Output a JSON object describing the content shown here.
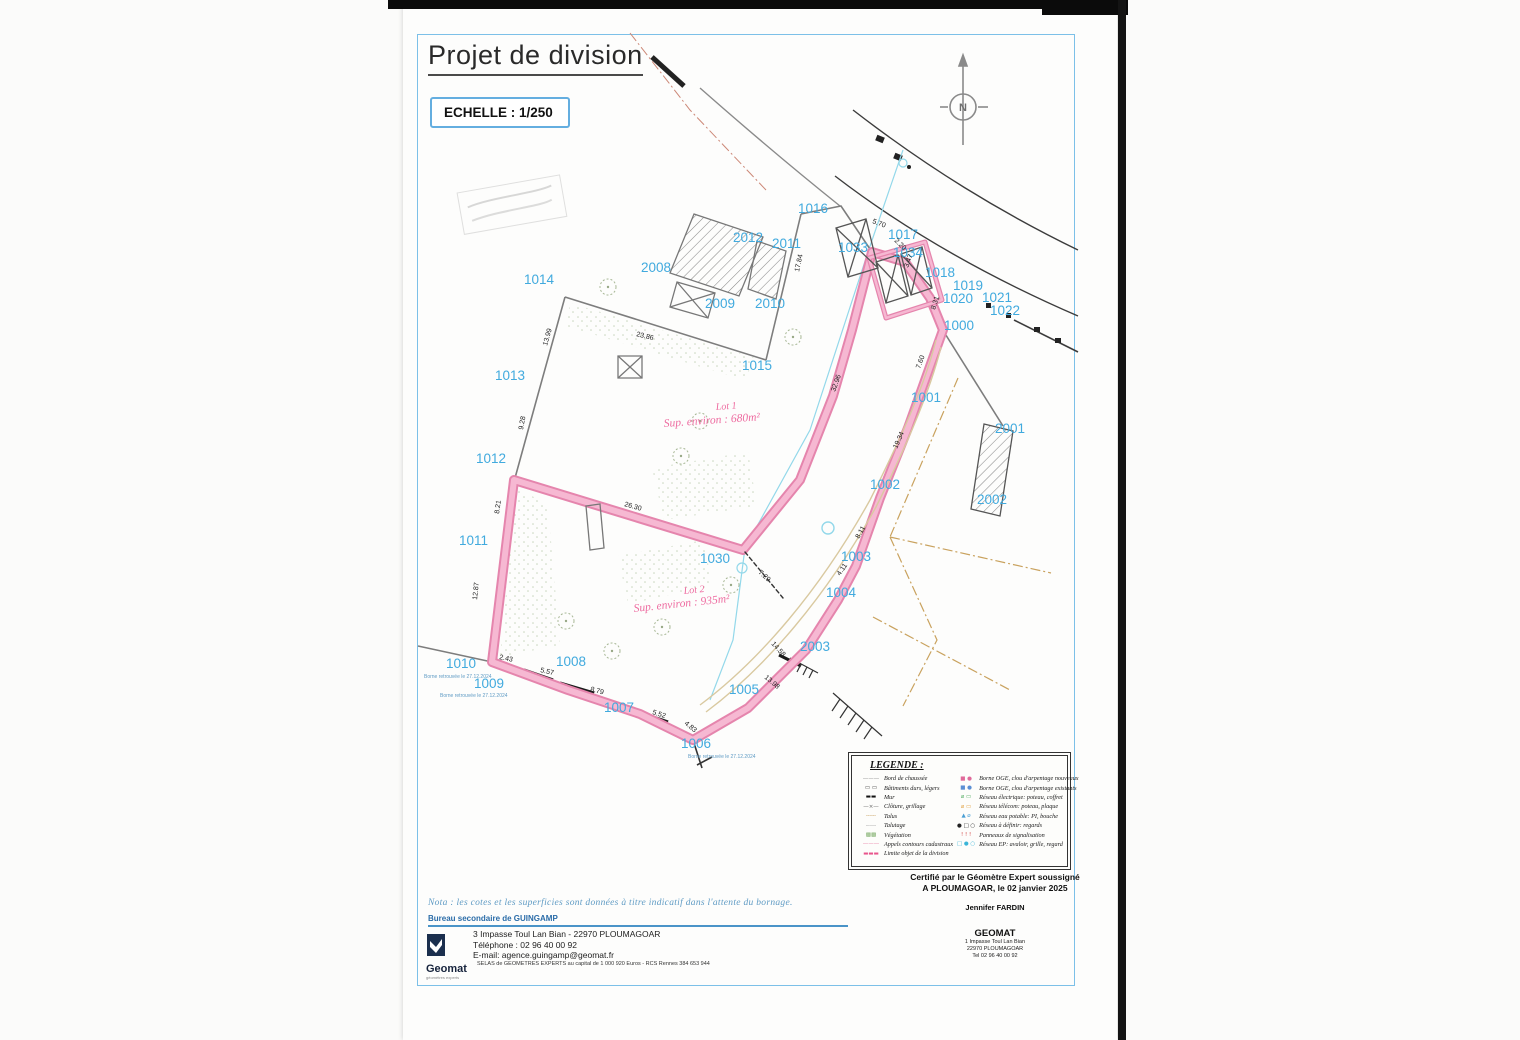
{
  "page": {
    "title": "Projet de division",
    "scale_label": "ECHELLE : 1/250",
    "north_letter": "N"
  },
  "lots": [
    {
      "name": "Lot 1",
      "sup": "Sup. environ : 680m²"
    },
    {
      "name": "Lot 2",
      "sup": "Sup. environ : 935m²"
    }
  ],
  "map": {
    "parcel_labels": [
      {
        "text": "1014",
        "x": 524,
        "y": 284
      },
      {
        "text": "1013",
        "x": 495,
        "y": 380
      },
      {
        "text": "1012",
        "x": 476,
        "y": 463
      },
      {
        "text": "1011",
        "x": 459,
        "y": 545
      },
      {
        "text": "1010",
        "x": 446,
        "y": 668
      },
      {
        "text": "1009",
        "x": 474,
        "y": 688
      },
      {
        "text": "1008",
        "x": 556,
        "y": 666
      },
      {
        "text": "1007",
        "x": 604,
        "y": 712
      },
      {
        "text": "1006",
        "x": 681,
        "y": 748
      },
      {
        "text": "1005",
        "x": 729,
        "y": 694
      },
      {
        "text": "1004",
        "x": 826,
        "y": 597
      },
      {
        "text": "1003",
        "x": 841,
        "y": 561
      },
      {
        "text": "1002",
        "x": 870,
        "y": 489
      },
      {
        "text": "1001",
        "x": 911,
        "y": 402
      },
      {
        "text": "1000",
        "x": 944,
        "y": 330
      },
      {
        "text": "1015",
        "x": 742,
        "y": 370
      },
      {
        "text": "1016",
        "x": 798,
        "y": 213
      },
      {
        "text": "1017",
        "x": 888,
        "y": 239
      },
      {
        "text": "1018",
        "x": 925,
        "y": 277
      },
      {
        "text": "1019",
        "x": 953,
        "y": 290
      },
      {
        "text": "1020",
        "x": 943,
        "y": 303
      },
      {
        "text": "1021",
        "x": 982,
        "y": 302
      },
      {
        "text": "1022",
        "x": 990,
        "y": 315
      },
      {
        "text": "1030",
        "x": 700,
        "y": 563
      },
      {
        "text": "1033",
        "x": 838,
        "y": 252
      },
      {
        "text": "1034",
        "x": 893,
        "y": 257
      },
      {
        "text": "2001",
        "x": 995,
        "y": 433
      },
      {
        "text": "2002",
        "x": 977,
        "y": 504
      },
      {
        "text": "2003",
        "x": 800,
        "y": 651
      },
      {
        "text": "2008",
        "x": 641,
        "y": 272
      },
      {
        "text": "2009",
        "x": 705,
        "y": 308
      },
      {
        "text": "2010",
        "x": 755,
        "y": 308
      },
      {
        "text": "2011",
        "x": 772,
        "y": 248
      },
      {
        "text": "2012",
        "x": 733,
        "y": 242
      }
    ],
    "measurements": [
      {
        "text": "23.86",
        "x": 636,
        "y": 336,
        "rot": 14
      },
      {
        "text": "17.84",
        "x": 799,
        "y": 272,
        "rot": -78
      },
      {
        "text": "13.99",
        "x": 547,
        "y": 346,
        "rot": -74
      },
      {
        "text": "9.28",
        "x": 523,
        "y": 430,
        "rot": -80
      },
      {
        "text": "8.21",
        "x": 499,
        "y": 514,
        "rot": -82
      },
      {
        "text": "12.87",
        "x": 477,
        "y": 600,
        "rot": -84
      },
      {
        "text": "2.43",
        "x": 499,
        "y": 659,
        "rot": 12
      },
      {
        "text": "5.57",
        "x": 540,
        "y": 672,
        "rot": 13
      },
      {
        "text": "8.79",
        "x": 590,
        "y": 691,
        "rot": 15
      },
      {
        "text": "5.52",
        "x": 652,
        "y": 714,
        "rot": 18
      },
      {
        "text": "4.83",
        "x": 684,
        "y": 724,
        "rot": 40
      },
      {
        "text": "26.30",
        "x": 624,
        "y": 506,
        "rot": 16
      },
      {
        "text": "7.29",
        "x": 758,
        "y": 573,
        "rot": 42
      },
      {
        "text": "32.96",
        "x": 835,
        "y": 392,
        "rot": -70
      },
      {
        "text": "14.58",
        "x": 771,
        "y": 644,
        "rot": 48
      },
      {
        "text": "13.98",
        "x": 764,
        "y": 678,
        "rot": 40
      },
      {
        "text": "8.31",
        "x": 935,
        "y": 310,
        "rot": -72
      },
      {
        "text": "7.60",
        "x": 920,
        "y": 369,
        "rot": -70
      },
      {
        "text": "19.34",
        "x": 897,
        "y": 449,
        "rot": -66
      },
      {
        "text": "8.11",
        "x": 859,
        "y": 539,
        "rot": -60
      },
      {
        "text": "4.11",
        "x": 840,
        "y": 576,
        "rot": -55
      },
      {
        "text": "5.70",
        "x": 872,
        "y": 223,
        "rot": 20
      },
      {
        "text": "2.20",
        "x": 894,
        "y": 241,
        "rot": 45
      },
      {
        "text": "3.47",
        "x": 908,
        "y": 268,
        "rot": -70
      }
    ],
    "borne_notes": [
      {
        "text": "Borne retrouvée le 27.12.2024",
        "x": 424,
        "y": 678
      },
      {
        "text": "Borne retrouvée le 27.12.2024",
        "x": 440,
        "y": 697
      },
      {
        "text": "Borne retrouvée le 27.12.2024",
        "x": 688,
        "y": 758
      }
    ],
    "trees": [
      [
        608,
        287
      ],
      [
        681,
        456
      ],
      [
        793,
        337
      ],
      [
        566,
        621
      ],
      [
        612,
        651
      ],
      [
        662,
        627
      ],
      [
        731,
        585
      ],
      [
        700,
        421
      ]
    ]
  },
  "legend": {
    "title": "LEGENDE :",
    "left": [
      {
        "label": "Bord de chaussée",
        "sym": "———",
        "color": "#8a8a8a"
      },
      {
        "label": "Bâtiments durs, légers",
        "sym": "▭ ▭",
        "color": "#444444"
      },
      {
        "label": "Mur",
        "sym": "▬▬",
        "color": "#111111"
      },
      {
        "label": "Clôture, grillage",
        "sym": "—×—",
        "color": "#666666"
      },
      {
        "label": "Talus",
        "sym": "╌╌╌",
        "color": "#c8a05e"
      },
      {
        "label": "Talutage",
        "sym": "┄┄┄",
        "color": "#999999"
      },
      {
        "label": "Végétation",
        "sym": "▩▩",
        "color": "#7fae6b"
      },
      {
        "label": "Appels contours cadastraux",
        "sym": "———",
        "color": "#e87fa6"
      },
      {
        "label": "Limite objet de la division",
        "sym": "▬▬▬",
        "color": "#e8558c"
      }
    ],
    "right": [
      {
        "label": "Borne OGE, clou d'arpentage nouveaux",
        "sym": "■ ●",
        "color": "#e06a9a"
      },
      {
        "label": "Borne OGE, clou d'arpentage existants",
        "sym": "■ ●",
        "color": "#5b8fd4"
      },
      {
        "label": "Réseau électrique: poteau, coffret",
        "sym": "⌀ ▭",
        "color": "#4faa5e"
      },
      {
        "label": "Réseau télécom: poteau, plaque",
        "sym": "⌀ ▭",
        "color": "#e0a040"
      },
      {
        "label": "Réseau eau potable: PI, bouche",
        "sym": "▲ ⌀",
        "color": "#4a9fd4"
      },
      {
        "label": "Réseau à définir: regards",
        "sym": "● □ ○",
        "color": "#222222"
      },
      {
        "label": "Panneaux de signalisation",
        "sym": "! ! !",
        "color": "#d04040"
      },
      {
        "label": "Réseau EP: avaloir, grille, regard",
        "sym": "□ ● ○",
        "color": "#3ab5d8"
      }
    ]
  },
  "nota": "Nota : les cotes et les superficies sont données à titre indicatif dans l'attente du bornage.",
  "office": {
    "bureau": "Bureau secondaire de GUINGAMP",
    "brand": "Geomat",
    "tagline": "géomètres experts",
    "address": "3 Impasse Toul Lan Bian - 22970 PLOUMAGOAR",
    "phone": "Téléphone : 02 96 40 00 92",
    "email": "E-mail: agence.guingamp@geomat.fr",
    "legal": "SELAS de GEOMETRES EXPERTS au capital de 1 000 920 Euros - RCS Rennes 384 653 944"
  },
  "certification": {
    "line1": "Certifié par le Géomètre Expert soussigné",
    "line2": "A PLOUMAGOAR, le 02 janvier 2025",
    "name": "Jennifer FARDIN",
    "firm": "GEOMAT",
    "addr1": "1 Impasse Toul Lan Bian",
    "addr2": "22970 PLOUMAGOAR",
    "tel": "Tel 02 96 40 00 92"
  },
  "colors": {
    "division_outer": "#e585ad",
    "division_inner": "#f6b8d2",
    "parcel_label": "#41aade",
    "frame_blue": "#7cc0e8",
    "cadastre_tan": "#c9a25e",
    "network_cyan": "#93d8ea"
  }
}
